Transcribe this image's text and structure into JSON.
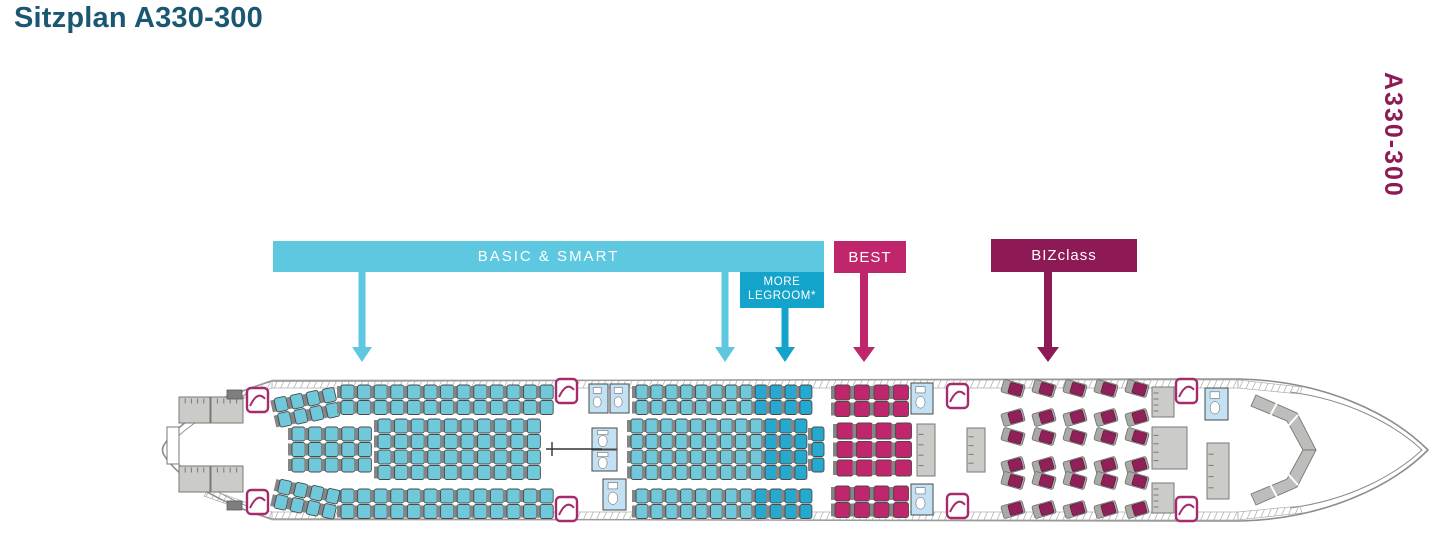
{
  "page": {
    "title": "Sitzplan A330-300",
    "side_label": "A330-300"
  },
  "colors": {
    "title": "#1a5871",
    "side_label": "#8e1a55",
    "economy": "#6fc9da",
    "legroom": "#26a9cf",
    "best": "#c0266b",
    "biz_seat": "#8f2158",
    "biz_shell": "#a9a9a6",
    "seat_back": "#858585",
    "seat_outline": "#4a4a4a",
    "fuselage_outline": "#8c8c8c",
    "fuselage_fill": "#ffffff",
    "hatch": "#9a9a9a",
    "galley_fill": "#cbcbc8",
    "galley_stroke": "#787878",
    "galley_dark": "#7e7e7e",
    "lav_fill": "#c3e1f2",
    "lav_stroke": "#4a4a4a",
    "door": "#a62b6c",
    "cockpit_fill": "#bdbdbb",
    "cockpit_stroke": "#777777"
  },
  "legend": {
    "basic_smart": {
      "label": "BASIC & SMART",
      "color": "#5ec8e0",
      "box": [
        273,
        241,
        551,
        31
      ],
      "arrows_x": [
        362,
        725
      ],
      "arrow_top": 272
    },
    "more_legroom": {
      "label_line1": "MORE",
      "label_line2": "LEGROOM*",
      "color": "#14a3cb",
      "box": [
        740,
        272,
        84,
        36
      ],
      "arrows_x": [
        785
      ],
      "arrow_top": 308
    },
    "best": {
      "label": "BEST",
      "color": "#c0266b",
      "box": [
        834,
        241,
        72,
        32
      ],
      "arrows_x": [
        864
      ],
      "arrow_top": 273
    },
    "bizclass": {
      "label": "BIZclass",
      "color": "#8e1a55",
      "box": [
        991,
        239,
        146,
        33
      ],
      "arrows_x": [
        1048
      ],
      "arrow_top": 272
    }
  },
  "seatmap": {
    "arrow_tip_y": 362,
    "bands": [
      {
        "name": "rear-economy-top-angled",
        "x": 277,
        "y": 397,
        "cols": 4,
        "rows": 2,
        "px": 16,
        "py": 15.5,
        "w": 12,
        "h": 14,
        "color": "economy",
        "angle": -13,
        "slope": -3
      },
      {
        "name": "rear-economy-top",
        "x": 341,
        "y": 385,
        "cols": 13,
        "rows": 2,
        "px": 16.6,
        "py": 15.5,
        "w": 13,
        "h": 14,
        "color": "economy"
      },
      {
        "name": "rear-economy-middle-3",
        "x": 292,
        "y": 427,
        "cols": 5,
        "rows": 3,
        "px": 16.6,
        "py": 15.5,
        "w": 13,
        "h": 14,
        "color": "economy"
      },
      {
        "name": "rear-economy-middle-4",
        "x": 378,
        "y": 419,
        "cols": 10,
        "rows": 4,
        "px": 16.6,
        "py": 15.5,
        "w": 13,
        "h": 14,
        "color": "economy"
      },
      {
        "name": "rear-economy-bottom",
        "x": 341,
        "y": 489,
        "cols": 13,
        "rows": 2,
        "px": 16.6,
        "py": 15.5,
        "w": 13,
        "h": 14,
        "color": "economy"
      },
      {
        "name": "rear-economy-bottom-angled",
        "x": 277,
        "y": 480,
        "cols": 4,
        "rows": 2,
        "px": 16,
        "py": 15.5,
        "w": 12,
        "h": 14,
        "color": "economy",
        "angle": 13,
        "slope": 3
      },
      {
        "name": "mid-economy-top",
        "x": 636,
        "y": 385,
        "cols": 12,
        "rows": 2,
        "px": 14.9,
        "py": 15.5,
        "w": 12,
        "h": 14,
        "color": "economy",
        "split": 8,
        "color2": "legroom"
      },
      {
        "name": "mid-economy-middle",
        "x": 631,
        "y": 419,
        "cols": 12,
        "rows": 4,
        "px": 14.9,
        "py": 15.5,
        "w": 12,
        "h": 14,
        "color": "economy",
        "split": 9,
        "color2": "legroom"
      },
      {
        "name": "mid-legroom-extra-column",
        "x": 812,
        "y": 427,
        "cols": 1,
        "rows": 3,
        "px": 14.9,
        "py": 15.5,
        "w": 12,
        "h": 14,
        "color": "legroom"
      },
      {
        "name": "mid-economy-bottom",
        "x": 636,
        "y": 489,
        "cols": 12,
        "rows": 2,
        "px": 14.9,
        "py": 15.5,
        "w": 12,
        "h": 14,
        "color": "economy",
        "split": 8,
        "color2": "legroom"
      },
      {
        "name": "best-top",
        "x": 835,
        "y": 385,
        "cols": 4,
        "rows": 2,
        "px": 19.5,
        "py": 16.5,
        "w": 15,
        "h": 15,
        "color": "best"
      },
      {
        "name": "best-middle",
        "x": 837,
        "y": 423,
        "cols": 4,
        "rows": 3,
        "px": 19.5,
        "py": 18.5,
        "w": 16,
        "h": 16,
        "color": "best"
      },
      {
        "name": "best-bottom",
        "x": 835,
        "y": 486,
        "cols": 4,
        "rows": 2,
        "px": 19.5,
        "py": 16.5,
        "w": 15,
        "h": 15,
        "color": "best"
      }
    ],
    "biz": {
      "x0": 1002,
      "pitch": 31,
      "cols": 5,
      "rows_yc": [
        403,
        451,
        495
      ],
      "shell_w": 22,
      "shell_h": 13,
      "seat_w": 13,
      "seat_h": 11,
      "angle": 16,
      "gap": 8
    },
    "lavatories": [
      [
        589,
        384,
        19,
        29
      ],
      [
        610,
        384,
        19,
        29
      ],
      [
        592,
        428,
        25,
        21
      ],
      [
        592,
        450,
        25,
        21
      ],
      [
        603,
        479,
        23,
        31
      ],
      [
        911,
        383,
        22,
        31
      ],
      [
        911,
        484,
        22,
        31
      ],
      [
        1205,
        388,
        23,
        32
      ]
    ],
    "galleys": [
      [
        179,
        397,
        31,
        26
      ],
      [
        211,
        397,
        32,
        26
      ],
      [
        179,
        466,
        31,
        26
      ],
      [
        211,
        466,
        32,
        26
      ],
      [
        917,
        424,
        18,
        52
      ],
      [
        967,
        428,
        18,
        44
      ],
      [
        1152,
        387,
        22,
        30
      ],
      [
        1152,
        483,
        22,
        30
      ],
      [
        1152,
        427,
        35,
        42
      ],
      [
        1207,
        443,
        22,
        56
      ]
    ],
    "galleys_dark": [
      [
        227,
        390,
        15,
        9
      ],
      [
        227,
        501,
        15,
        9
      ]
    ],
    "tail_white_rect": [
      167,
      427,
      12,
      37
    ],
    "doors": [
      [
        247,
        388
      ],
      [
        247,
        490
      ],
      [
        556,
        379
      ],
      [
        556,
        497
      ],
      [
        947,
        384
      ],
      [
        947,
        494
      ],
      [
        1176,
        379
      ],
      [
        1176,
        497
      ]
    ],
    "door_size": [
      21,
      24
    ],
    "section_marker": {
      "line": [
        546,
        449,
        602,
        449
      ],
      "tick": [
        552,
        442,
        552,
        456
      ]
    }
  }
}
